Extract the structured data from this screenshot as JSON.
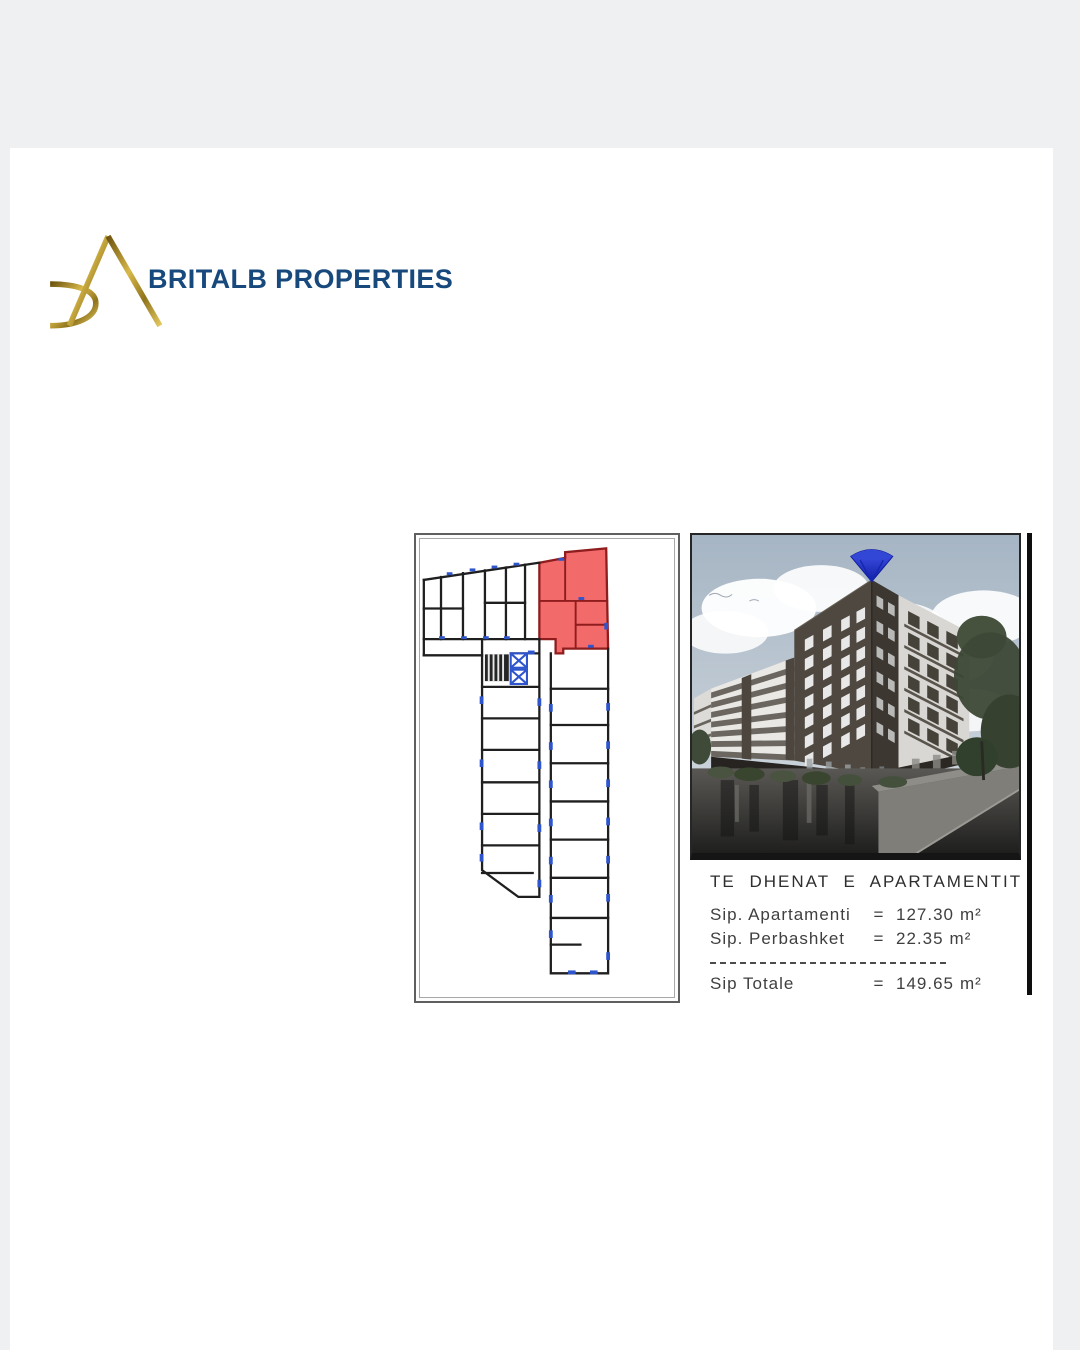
{
  "theme": {
    "background": "#eef0f2",
    "page": "#ffffff",
    "brand_navy": "#17497d",
    "gold": "#b99022",
    "highlight_red": "#f26a6a",
    "marker_blue": "#2f55cc"
  },
  "header": {
    "brand": "BRITALB PROPERTIES",
    "logo": "britalb-gold-monogram"
  },
  "scan": {
    "plan_panel": {
      "name": "floor-plan-with-highlighted-unit"
    },
    "photo_panel": {
      "name": "building-exterior-render-with-blue-gem"
    },
    "details": {
      "title": "TE DHENAT E APARTAMENTIT",
      "equals": "=",
      "rows": [
        {
          "label": "Sip. Apartamenti",
          "value": "127.30",
          "unit": "m²"
        },
        {
          "label": "Sip. Perbashket",
          "value": "22.35",
          "unit": "m²"
        }
      ],
      "total": {
        "label": "Sip Totale",
        "value": "149.65",
        "unit": "m²"
      }
    }
  }
}
